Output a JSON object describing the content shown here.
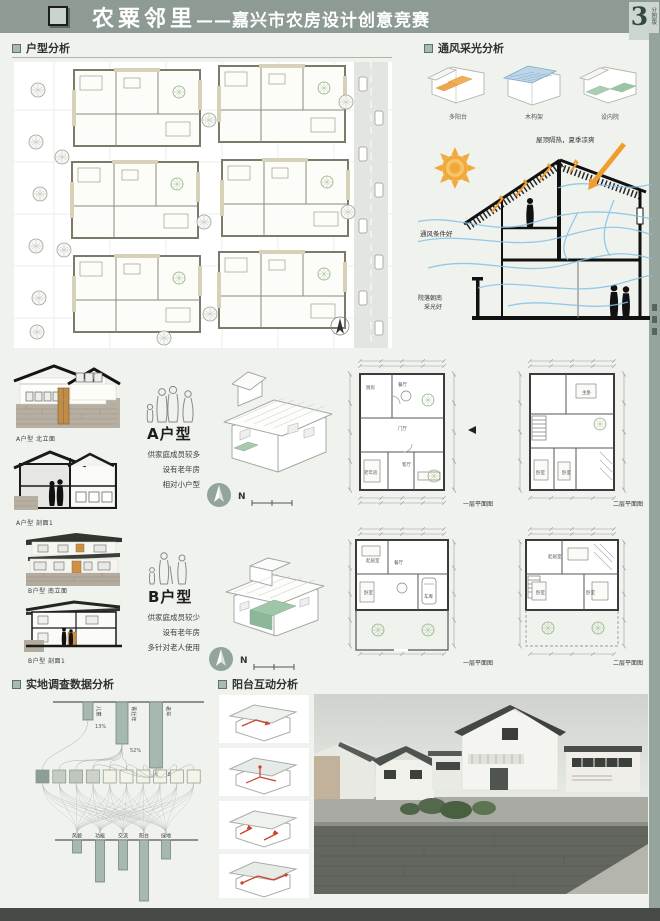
{
  "header": {
    "title_main": "农粟邻里",
    "title_sub": "——嘉兴市农房设计创意竞赛",
    "badge_number": "3",
    "badge_caption": "分图版"
  },
  "sections": {
    "unit_analysis": "户型分析",
    "ventilation": "通风采光分析",
    "survey": "实地调查数据分析",
    "balcony": "阳台互动分析"
  },
  "vent": {
    "axon_labels": [
      "多阳台",
      "木构架",
      "设内院"
    ],
    "roof_note": "屋顶隔热，夏季凉爽",
    "wind_note": "通风条件好",
    "court_note1": "院落朝南",
    "court_note2": "采光好"
  },
  "unit_a": {
    "title": "A户型",
    "desc": [
      "供家庭成员较多",
      "设有老年房",
      "相对小户型"
    ],
    "elev_cap": "A户型 北立面",
    "sect_cap": "A户型 剖面1",
    "plan1_cap": "一层平面图",
    "plan2_cap": "二层平面图",
    "north": "N",
    "rooms_f1": [
      "厨房",
      "餐厅",
      "门厅",
      "老年房",
      "客厅"
    ],
    "rooms_f2": [
      "主卧",
      "卧室",
      "卧室"
    ]
  },
  "unit_b": {
    "title": "B户型",
    "desc": [
      "供家庭成员较少",
      "设有老年房",
      "多针对老人使用"
    ],
    "elev_cap": "B户型 南立面",
    "sect_cap": "B户型 剖面1",
    "plan1_cap": "一层平面图",
    "plan2_cap": "二层平面图",
    "north": "N",
    "rooms_f1": [
      "起居室",
      "餐厅",
      "卧室",
      "车库"
    ],
    "rooms_f2": [
      "起居室",
      "卧室",
      "卧室"
    ]
  },
  "chart_data": {
    "type": "bar",
    "title": "实地调查数据分析",
    "top_bars": {
      "categories": [
        "儿童",
        "青壮年",
        "老年"
      ],
      "values_pct": [
        13,
        52,
        58
      ],
      "labels": [
        "13%",
        "52%",
        "58%"
      ]
    },
    "link_squares": {
      "count": 10,
      "colors": [
        "#8c9f96",
        "#c6ccc4",
        "#c0c6be",
        "#cdd2ca",
        "#f2f2e6",
        "#f4f4e8",
        "#f2f2e6",
        "#f4f4e8",
        "#f2f2e6",
        "#f4f4e8"
      ]
    },
    "bottom_bars": {
      "categories": [
        "风貌",
        "功能",
        "交流",
        "阳台",
        "绿地"
      ],
      "values_rel": [
        0.2,
        0.65,
        0.47,
        0.95,
        0.3
      ]
    }
  },
  "colors": {
    "header_bar": "#8d9b94",
    "sage": "#a7b8ae",
    "accent_orange": "#ef9e2e",
    "wind_blue": "#83c2e6",
    "court_green": "#9fc6a8",
    "dark_roof": "#31352f"
  }
}
